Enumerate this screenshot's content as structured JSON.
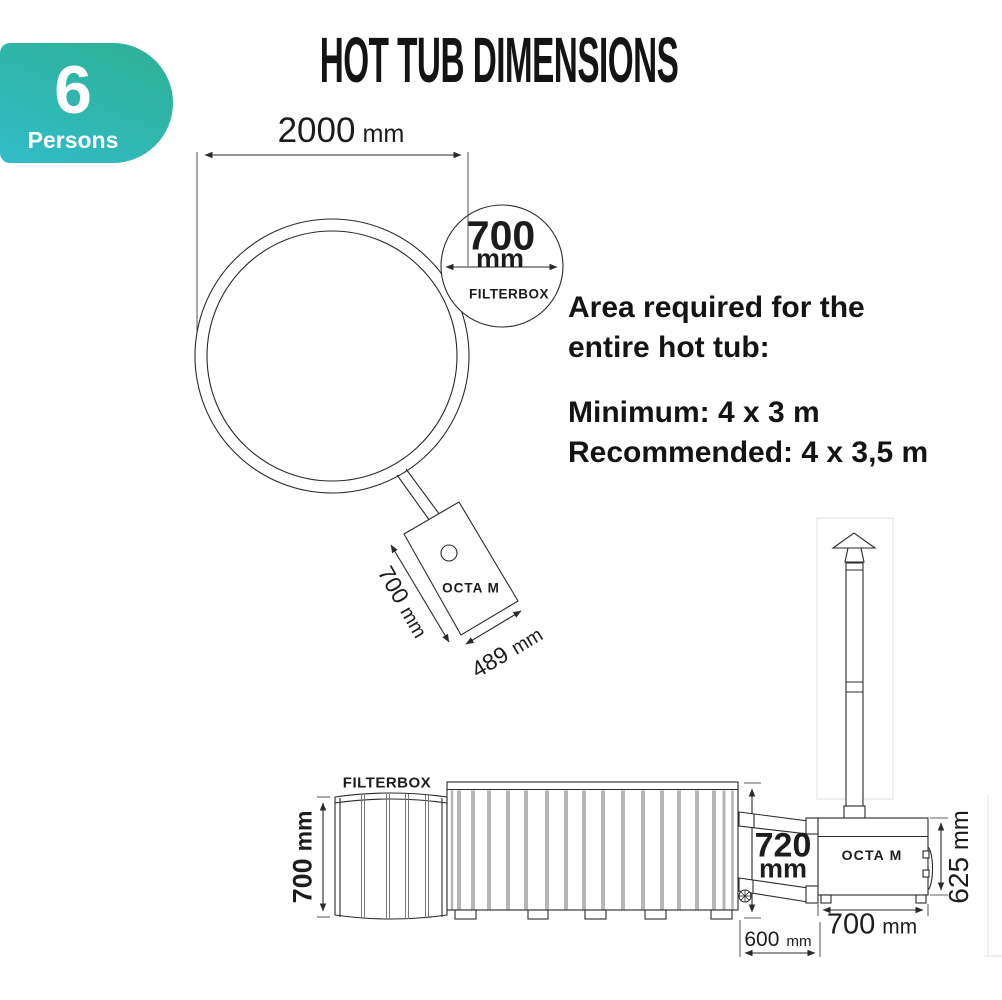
{
  "title": "HOT TUB DIMENSIONS",
  "badge": {
    "count": "6",
    "label": "Persons"
  },
  "colors": {
    "badge_gradient_top": "#2db093",
    "badge_gradient_bottom": "#32bdc9",
    "line": "#2a2a2a",
    "slat": "#b6b6b6",
    "text": "#1c1c1c"
  },
  "top_view": {
    "diameter": {
      "value": "2000",
      "unit": "mm"
    },
    "filterbox_diameter": {
      "value": "700",
      "unit": "mm"
    },
    "filterbox_caption": "FILTERBOX",
    "stove_name": "OCTA M",
    "stove_depth": {
      "value": "700",
      "unit": "mm"
    },
    "stove_width": {
      "value": "489",
      "unit": "mm"
    }
  },
  "area_requirements": {
    "heading_line1": "Area required for the",
    "heading_line2": "entire hot tub:",
    "minimum": "Minimum: 4 x 3 m",
    "recommended": "Recommended: 4 x 3,5 m"
  },
  "side_view": {
    "filterbox_caption": "FILTERBOX",
    "filterbox_height": {
      "value": "700",
      "unit": "mm"
    },
    "stove_name": "OCTA M",
    "connection_height": {
      "value": "720",
      "unit": "mm"
    },
    "stove_height": {
      "value": "625",
      "unit": "mm"
    },
    "stove_width": {
      "value": "700",
      "unit": "mm"
    },
    "stove_offset": {
      "value": "600",
      "unit": "mm"
    }
  }
}
